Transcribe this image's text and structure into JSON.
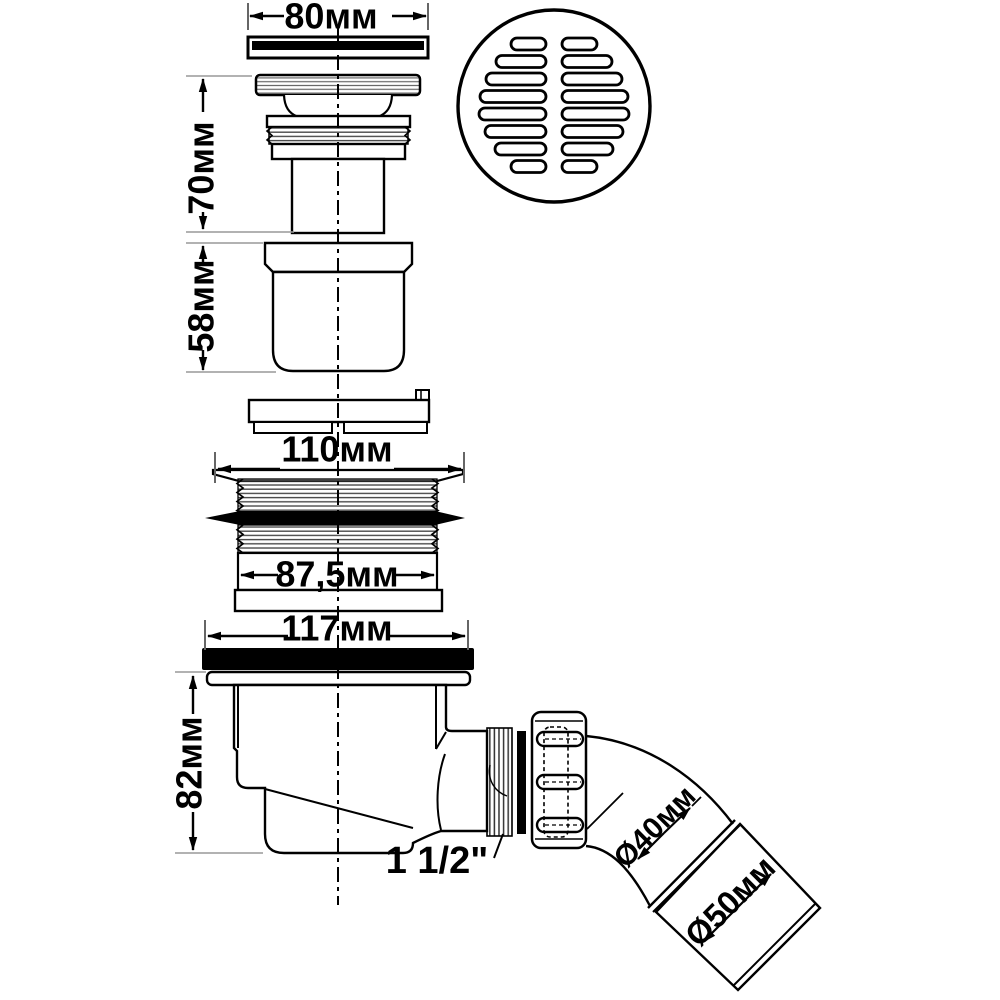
{
  "drawing": {
    "kind": "technical-drawing-exploded-view",
    "subject": "shower-drain-trap",
    "colors": {
      "line": "#000000",
      "background": "#ffffff",
      "seal": "#000000",
      "extension_line": "#999999",
      "thread_hatch": "#4a4a4a"
    },
    "parts": [
      "drain-cover-cap",
      "drain-grate",
      "mushroom-valve-assembly",
      "drain-cup",
      "bayonet-disc",
      "threaded-flange-body",
      "rubber-seal-band",
      "seal-ring",
      "rubber-gasket",
      "trap-body",
      "outlet-thread",
      "seal-washer",
      "union-nut",
      "outlet-elbow",
      "outlet-pipe",
      "pipe-sleeve"
    ]
  },
  "labels": {
    "d80": "80мм",
    "h70": "70мм",
    "h58": "58мм",
    "d110": "110мм",
    "d87_5": "87,5мм",
    "d117": "117мм",
    "h82": "82мм",
    "thread_size": "1 1/2\"",
    "d40": "Ø40мм",
    "d50": "Ø50мм"
  }
}
